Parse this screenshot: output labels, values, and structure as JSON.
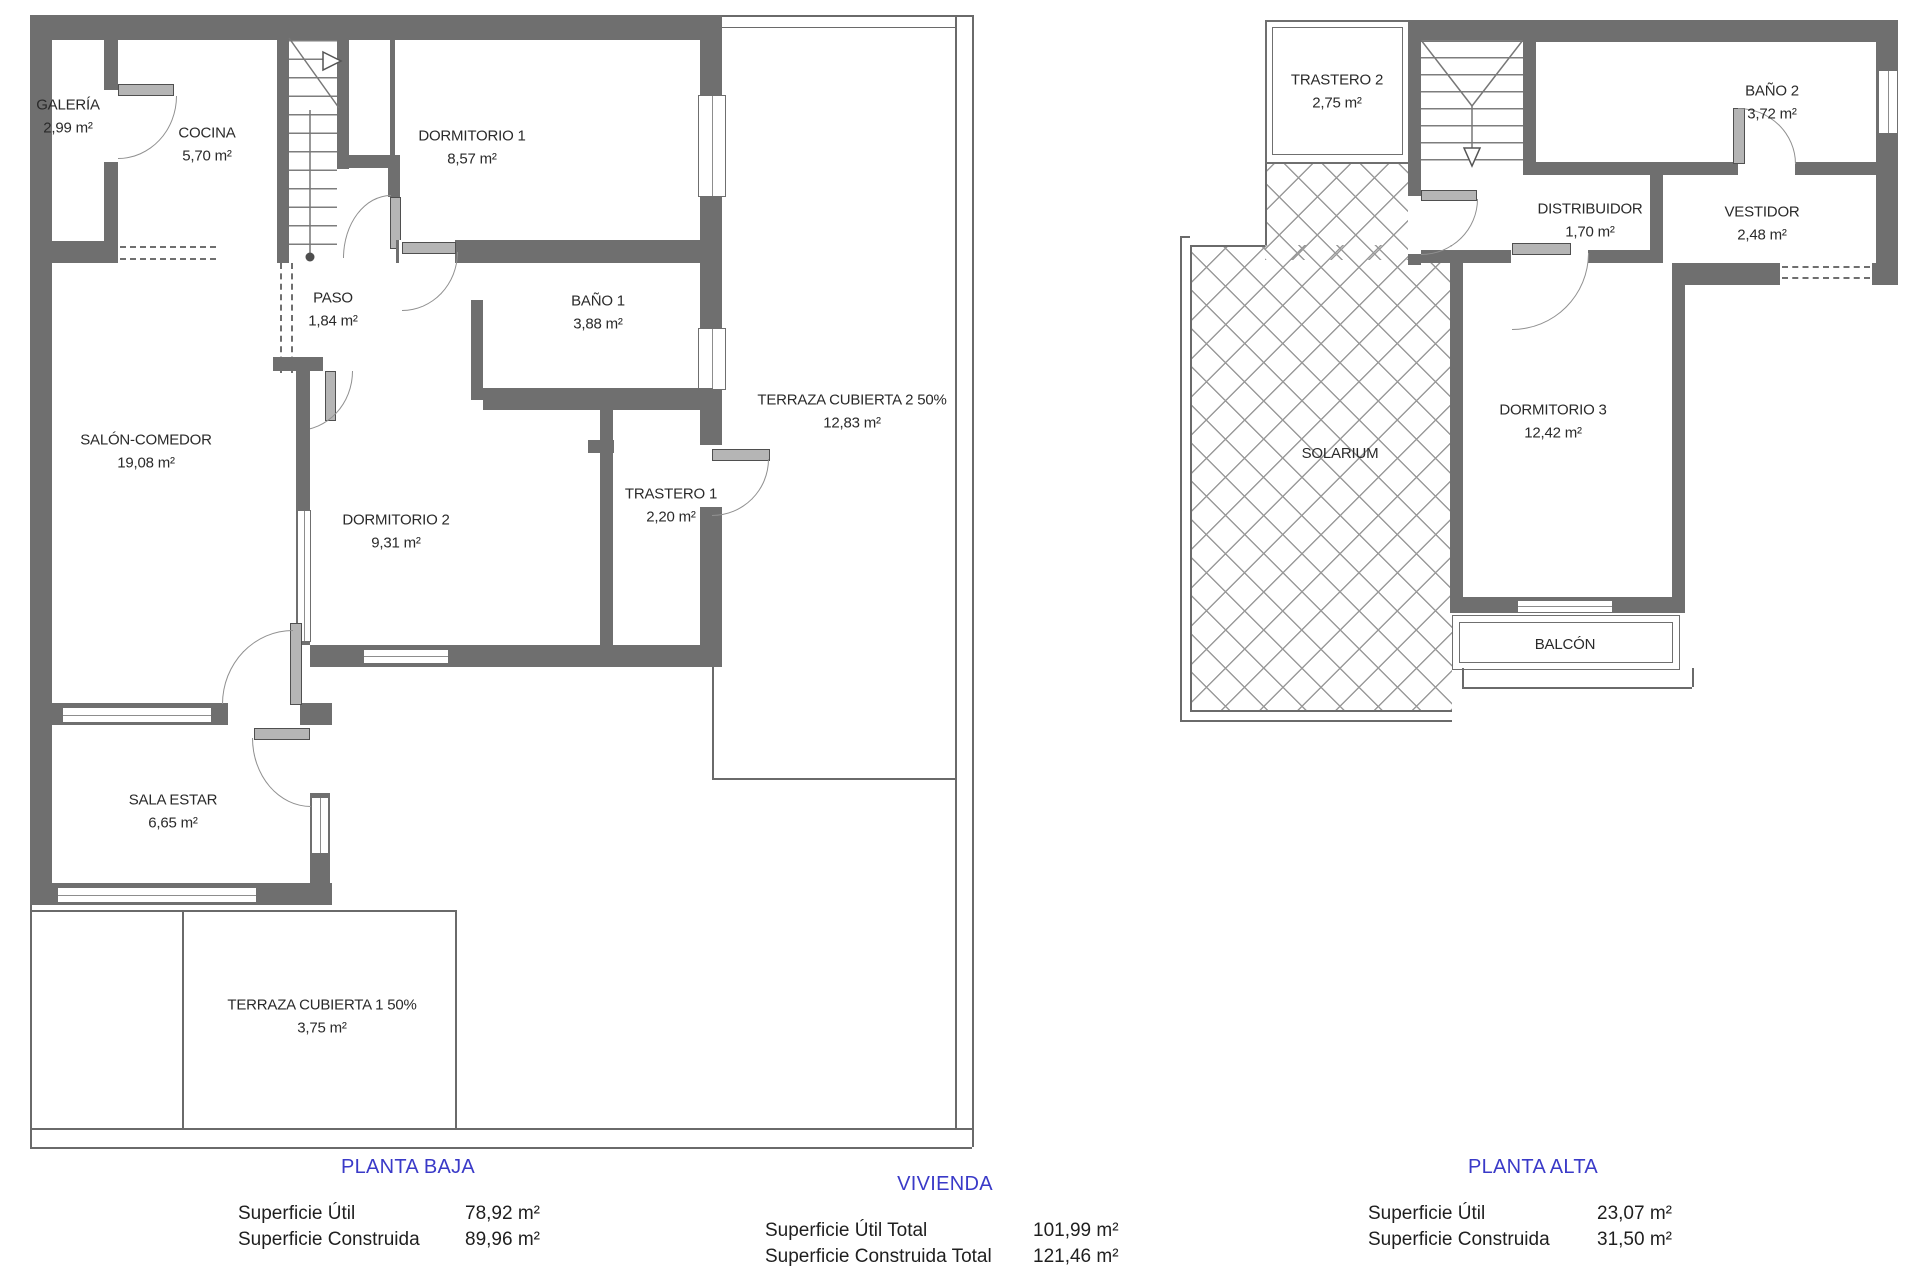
{
  "ground": {
    "title": "PLANTA BAJA",
    "rooms": {
      "galeria": {
        "name": "GALERÍA",
        "area": "2,99 m²"
      },
      "cocina": {
        "name": "COCINA",
        "area": "5,70 m²"
      },
      "dormitorio1": {
        "name": "DORMITORIO 1",
        "area": "8,57 m²"
      },
      "paso": {
        "name": "PASO",
        "area": "1,84 m²"
      },
      "bano1": {
        "name": "BAÑO 1",
        "area": "3,88 m²"
      },
      "terraza_cubierta2": {
        "name": "TERRAZA CUBIERTA 2 50%",
        "area": "12,83 m²"
      },
      "salon_comedor": {
        "name": "SALÓN-COMEDOR",
        "area": "19,08 m²"
      },
      "dormitorio2": {
        "name": "DORMITORIO 2",
        "area": "9,31 m²"
      },
      "trastero1": {
        "name": "TRASTERO 1",
        "area": "2,20 m²"
      },
      "sala_estar": {
        "name": "SALA ESTAR",
        "area": "6,65 m²"
      },
      "terraza_cubierta1": {
        "name": "TERRAZA CUBIERTA 1 50%",
        "area": "3,75 m²"
      }
    },
    "summary": [
      {
        "label": "Superficie Útil",
        "value": "78,92 m²"
      },
      {
        "label": "Superficie Construida",
        "value": "89,96 m²"
      }
    ]
  },
  "upper": {
    "title": "PLANTA ALTA",
    "rooms": {
      "trastero2": {
        "name": "TRASTERO 2",
        "area": "2,75 m²"
      },
      "bano2": {
        "name": "BAÑO 2",
        "area": "3,72 m²"
      },
      "distribuidor": {
        "name": "DISTRIBUIDOR",
        "area": "1,70 m²"
      },
      "vestidor": {
        "name": "VESTIDOR",
        "area": "2,48 m²"
      },
      "dormitorio3": {
        "name": "DORMITORIO 3",
        "area": "12,42 m²"
      },
      "solarium": {
        "name": "SOLARIUM"
      },
      "balcon": {
        "name": "BALCÓN"
      }
    },
    "summary": [
      {
        "label": "Superficie Útil",
        "value": "23,07 m²"
      },
      {
        "label": "Superficie Construida",
        "value": "31,50 m²"
      }
    ]
  },
  "vivienda": {
    "title": "VIVIENDA",
    "summary": [
      {
        "label": "Superficie Útil Total",
        "value": "101,99 m²"
      },
      {
        "label": "Superficie Construida Total",
        "value": "121,46 m²"
      }
    ]
  },
  "colors": {
    "wall": "#6f6f6f",
    "accent_title": "#3a3ac8"
  }
}
